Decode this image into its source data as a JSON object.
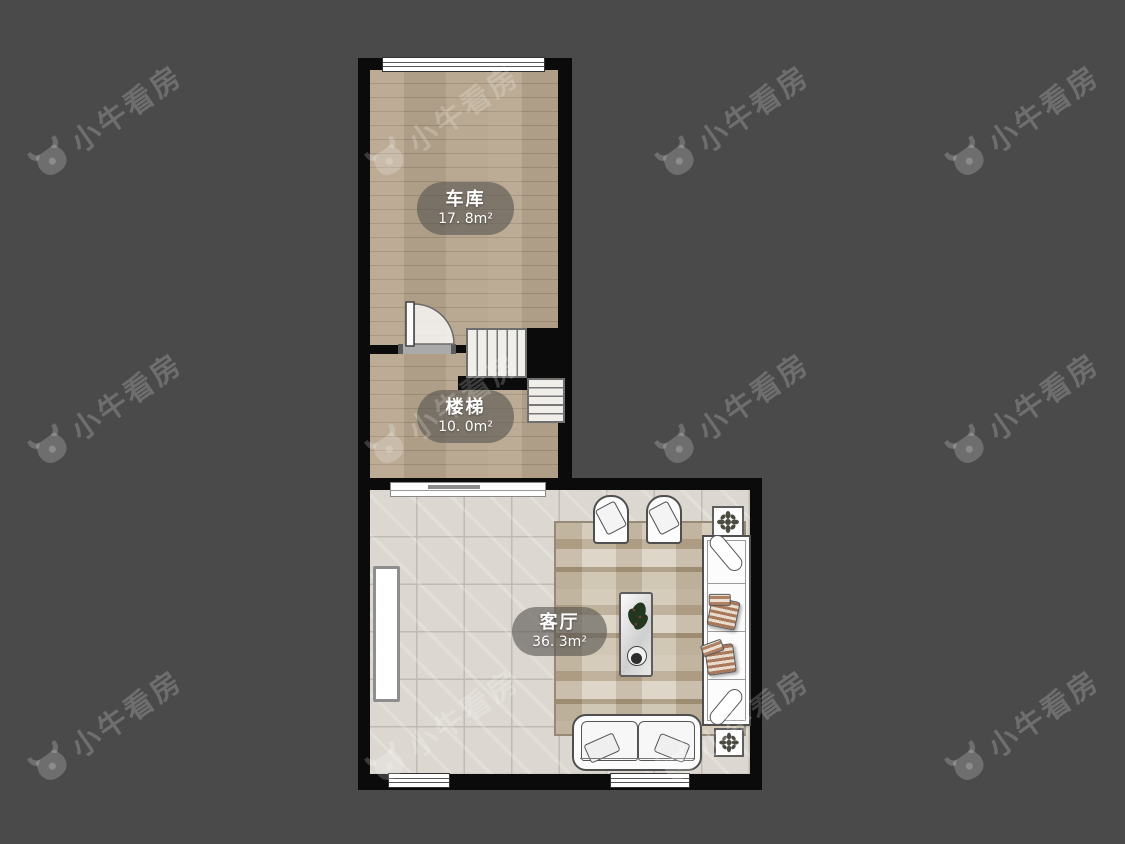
{
  "watermark": {
    "text": "小牛看房",
    "icon": "bull-logo-icon"
  },
  "floorplan": {
    "rooms": [
      {
        "id": "garage",
        "label": "车库",
        "area": "17. 8m²",
        "floor": "wood"
      },
      {
        "id": "stairs",
        "label": "楼梯",
        "area": "10. 0m²",
        "floor": "wood"
      },
      {
        "id": "living",
        "label": "客厅",
        "area": "36. 3m²",
        "floor": "tile"
      }
    ]
  },
  "colors": {
    "background": "#4a4a4a",
    "wall": "#0b0b0b",
    "wood_floor": "#b2a18a",
    "tile_floor": "#dcd8d1",
    "rug": "#c9bfab",
    "label_pill": "rgba(88,85,80,0.62)",
    "watermark": "rgba(255,255,255,0.20)"
  }
}
